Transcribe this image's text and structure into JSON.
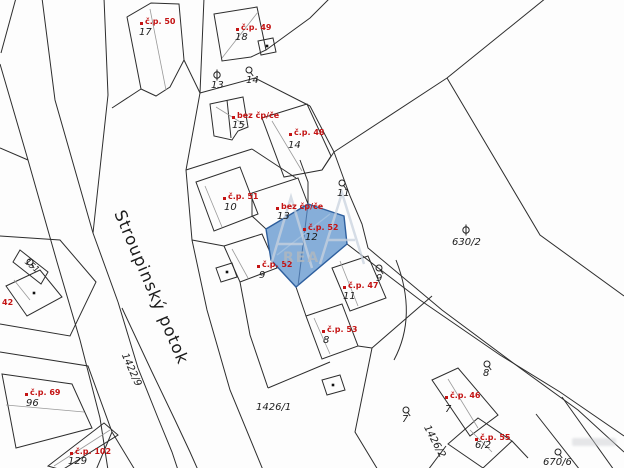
{
  "map": {
    "title": "cadastral-map",
    "stream_label": "Stroupinský potok",
    "highlight": {
      "house_number": "č.p. 52",
      "parcel_number": "12",
      "fill_color": "#86aed9",
      "border_color": "#2e5f9e"
    },
    "colors": {
      "line": "#2d2d2d",
      "thin_line": "#9a9a9a",
      "red_label": "#c41414",
      "black_label": "#1b1b1b",
      "background": "#fdfdfd"
    },
    "watermark": {
      "letters": "AA",
      "small_text": "REA"
    }
  },
  "labels": {
    "house_numbers": [
      {
        "text": "č.p. 50",
        "x": 145,
        "y": 18
      },
      {
        "text": "č.p. 49",
        "x": 241,
        "y": 24
      },
      {
        "text": "bez čp/če",
        "x": 237,
        "y": 112
      },
      {
        "text": "č.p. 48",
        "x": 294,
        "y": 129
      },
      {
        "text": "č.p. 51",
        "x": 228,
        "y": 193
      },
      {
        "text": "bez čp/če",
        "x": 281,
        "y": 203
      },
      {
        "text": "č.p. 52",
        "x": 308,
        "y": 224
      },
      {
        "text": "č.p. 52",
        "x": 262,
        "y": 261
      },
      {
        "text": "č.p. 47",
        "x": 348,
        "y": 282
      },
      {
        "text": "č.p. 53",
        "x": 327,
        "y": 326
      },
      {
        "text": "č.p. 46",
        "x": 450,
        "y": 392
      },
      {
        "text": "č.p. 55",
        "x": 480,
        "y": 434
      },
      {
        "text": "42",
        "x": 2,
        "y": 299
      },
      {
        "text": "č.p. 69",
        "x": 30,
        "y": 389
      },
      {
        "text": "č.p. 102",
        "x": 75,
        "y": 448
      }
    ],
    "parcel_numbers": [
      {
        "text": "17",
        "x": 139,
        "y": 28
      },
      {
        "text": "18",
        "x": 235,
        "y": 33
      },
      {
        "text": "13",
        "x": 211,
        "y": 81
      },
      {
        "text": "14",
        "x": 246,
        "y": 76
      },
      {
        "text": "15",
        "x": 232,
        "y": 121
      },
      {
        "text": "14",
        "x": 288,
        "y": 141
      },
      {
        "text": "10",
        "x": 224,
        "y": 203
      },
      {
        "text": "13",
        "x": 277,
        "y": 212
      },
      {
        "text": "12",
        "x": 305,
        "y": 233
      },
      {
        "text": "11",
        "x": 337,
        "y": 189
      },
      {
        "text": "630/2",
        "x": 452,
        "y": 238
      },
      {
        "text": "9",
        "x": 376,
        "y": 274
      },
      {
        "text": "9",
        "x": 259,
        "y": 271
      },
      {
        "text": "11",
        "x": 343,
        "y": 292
      },
      {
        "text": "8",
        "x": 323,
        "y": 336
      },
      {
        "text": "8",
        "x": 483,
        "y": 369
      },
      {
        "text": "7",
        "x": 402,
        "y": 415
      },
      {
        "text": "7",
        "x": 445,
        "y": 405
      },
      {
        "text": "6/2",
        "x": 475,
        "y": 441
      },
      {
        "text": "670/6",
        "x": 543,
        "y": 458
      },
      {
        "text": "96",
        "x": 26,
        "y": 399
      },
      {
        "text": "129",
        "x": 68,
        "y": 457
      },
      {
        "text": "1426/1",
        "x": 256,
        "y": 403
      }
    ],
    "rotated": [
      {
        "text": "Stroupinský potok",
        "x": 126,
        "y": 208,
        "rot": 67,
        "size": 16.5,
        "style": "normal",
        "name": "stream-name-label"
      },
      {
        "text": "1422/9",
        "x": 128,
        "y": 352,
        "rot": 66,
        "size": 10,
        "style": "italic",
        "name": "parcel-number-label-rotated"
      },
      {
        "text": "1426/2",
        "x": 430,
        "y": 424,
        "rot": 62,
        "size": 10,
        "style": "italic",
        "name": "parcel-number-label-rotated"
      },
      {
        "text": "151",
        "x": 28,
        "y": 258,
        "rot": 40,
        "size": 8.5,
        "style": "italic",
        "name": "parcel-number-label-rotated"
      }
    ]
  },
  "symbols": {
    "garden": [
      {
        "x": 249,
        "y": 70
      },
      {
        "x": 342,
        "y": 183
      },
      {
        "x": 379,
        "y": 268
      },
      {
        "x": 487,
        "y": 364
      },
      {
        "x": 406,
        "y": 410
      },
      {
        "x": 558,
        "y": 452
      },
      {
        "x": 30,
        "y": 262
      }
    ],
    "structure": [
      {
        "x": 217,
        "y": 75
      },
      {
        "x": 466,
        "y": 230
      }
    ],
    "building_dots": [
      {
        "x": 267,
        "y": 46
      },
      {
        "x": 34,
        "y": 293
      },
      {
        "x": 227,
        "y": 272
      },
      {
        "x": 333,
        "y": 385
      }
    ]
  }
}
